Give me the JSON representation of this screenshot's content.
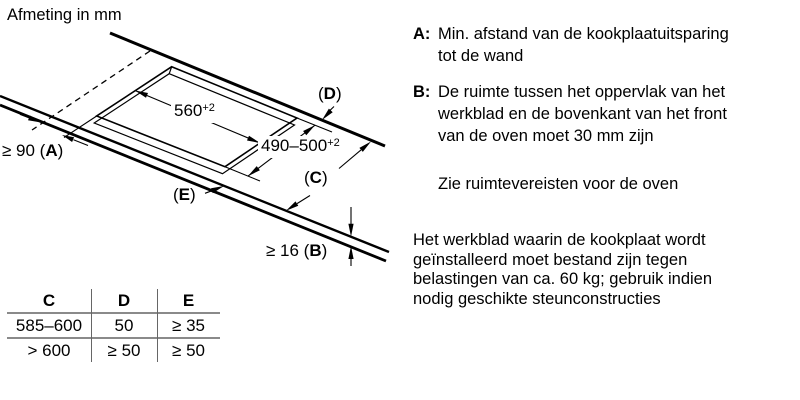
{
  "title": "Afmeting in mm",
  "diagram": {
    "dim_width": {
      "value": "560",
      "tol": "+2"
    },
    "dim_depth": {
      "value": "490–500",
      "tol": "+2"
    },
    "dim_a": {
      "pre": "≥ 90 (",
      "letter": "A",
      "post": ")"
    },
    "dim_b": {
      "pre": "≥ 16 (",
      "letter": "B",
      "post": ")"
    },
    "label_c": {
      "pre": "(",
      "letter": "C",
      "post": ")"
    },
    "label_d": {
      "pre": "(",
      "letter": "D",
      "post": ")"
    },
    "label_e": {
      "pre": "(",
      "letter": "E",
      "post": ")"
    }
  },
  "table": {
    "headers": [
      "C",
      "D",
      "E"
    ],
    "rows": [
      [
        "585–600",
        "50",
        "≥ 35"
      ],
      [
        "> 600",
        "≥ 50",
        "≥ 50"
      ]
    ]
  },
  "legend": [
    {
      "key": "A:",
      "text": "Min. afstand van de kookplaatuitsparing\ntot de wand"
    },
    {
      "key": "B:",
      "text": "De ruimte tussen het oppervlak van het\nwerkblad en de bovenkant van het front\nvan de oven moet 30 mm zijn"
    }
  ],
  "notes": {
    "oven_space": "Zie ruimtevereisten voor de oven",
    "worktop_load": "Het werkblad waarin de kookplaat wordt\ngeïnstalleerd moet bestand zijn tegen\nbelastingen van ca. 60 kg; gebruik indien\nnodig geschikte steunconstructies"
  },
  "colors": {
    "line": "#000000",
    "table_rule_horizontal": "#8a8a8a",
    "table_rule_vertical": "#666666"
  }
}
